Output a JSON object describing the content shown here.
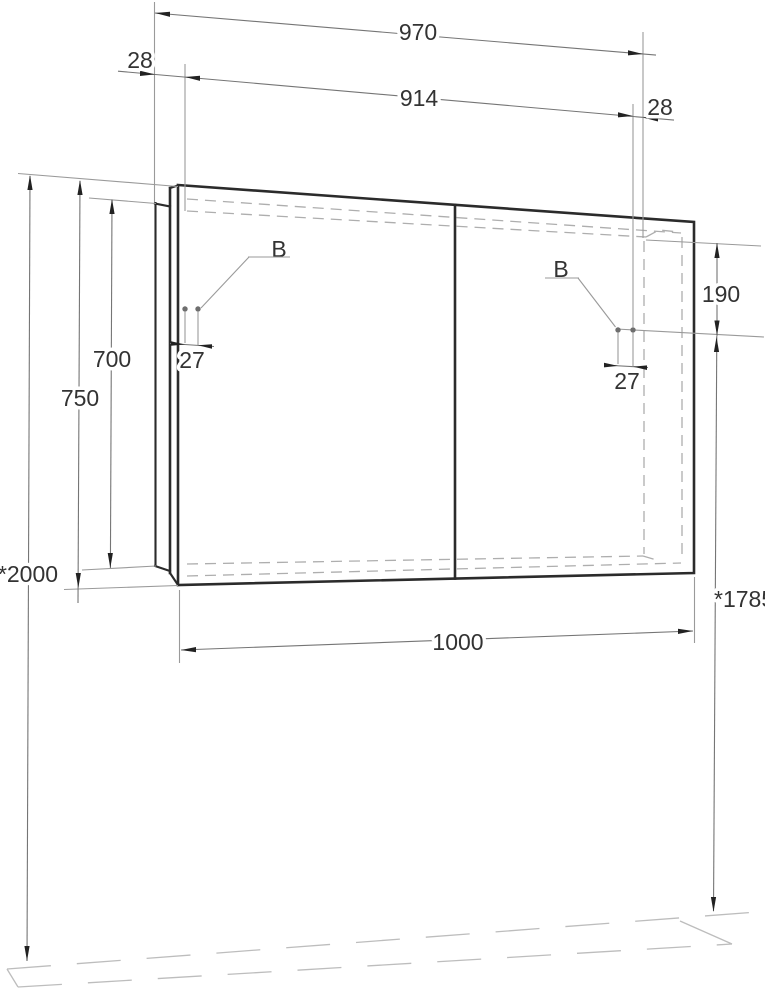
{
  "drawing": {
    "dims": {
      "overall_top": "970",
      "left_offset": "28",
      "inner_top": "914",
      "right_offset": "28",
      "hinge_height": "190",
      "left_hinge_pitch": "27",
      "right_hinge_pitch": "27",
      "body_height": "700",
      "front_height": "750",
      "top_mount_height": "*2000",
      "hinge_mount_height": "*1785",
      "width": "1000"
    },
    "labels": {
      "left_hinge": "B",
      "right_hinge": "B"
    },
    "colors": {
      "background": "#ffffff",
      "outline": "#2b2b2b",
      "dimension_line": "#757575",
      "extension_line": "#9a9a9a",
      "hidden_dash": "#aeaeae",
      "floor_line": "#bdbdbd",
      "arrow": "#222222",
      "text": "#333333",
      "hinge_dot": "#6e6e6e"
    }
  }
}
